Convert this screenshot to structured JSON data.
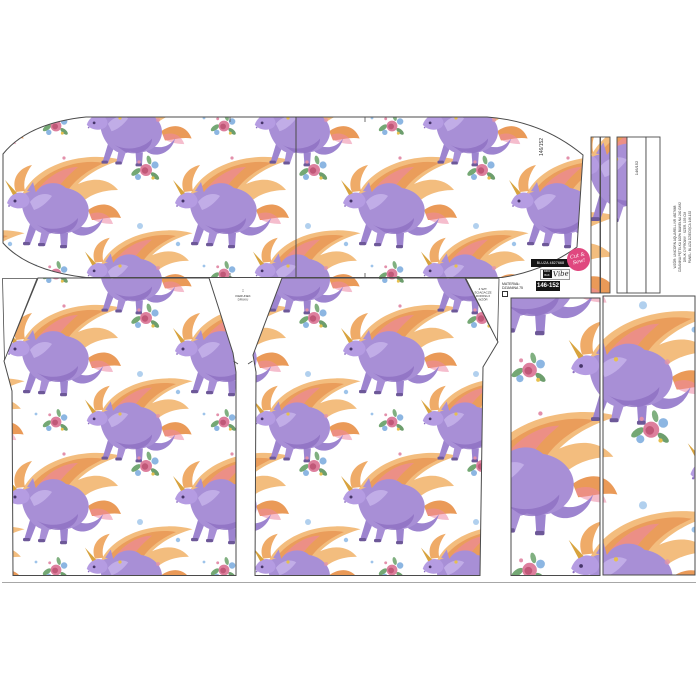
{
  "panel": {
    "sleeve_size_label": "146/152",
    "strip_size_label": "146/152"
  },
  "tag": {
    "product_code": "BLUZA 4827668",
    "mini_logo_top": "DZIO",
    "mini_logo_bottom": "BAK",
    "brand_script": "Vibe",
    "size_range": "146-152",
    "badge_line1": "Cut &",
    "badge_line2": "Sew!"
  },
  "notes": {
    "material_line1": "MATERIAŁ:",
    "material_line2": "DZIANINA 75",
    "grain_arrow": "↕",
    "grain_line1": "KIERUNEK",
    "grain_line2": "DRUKU",
    "cut_lines": [
      "4 SZT.",
      "ŚCIĄGACZE",
      "DOPASUJ",
      "WZÓR"
    ],
    "production_lines": [
      "WZÓR: UNICORN AQUARELL NR 4827668",
      "DZIANINA PĘTELKA 100% BAWEŁNA 240 G/M2",
      "DRUK CYFROWY · SZER. 155 CM",
      "PANEL: BLUZA DZIECIĘCA 146-152"
    ]
  },
  "colors": {
    "outline": "#4b4b4b",
    "unicorn_purple": "#a88fd6",
    "mane_gold": "#f3bd7e",
    "mane_orange": "#ea9a58",
    "mane_pink": "#ec86a4",
    "flower_pink": "#dd7f9d",
    "flower_blue": "#8cb6e2",
    "leaf_green": "#74a874",
    "badge_pink": "#e0487f",
    "tag_black": "#141414"
  }
}
